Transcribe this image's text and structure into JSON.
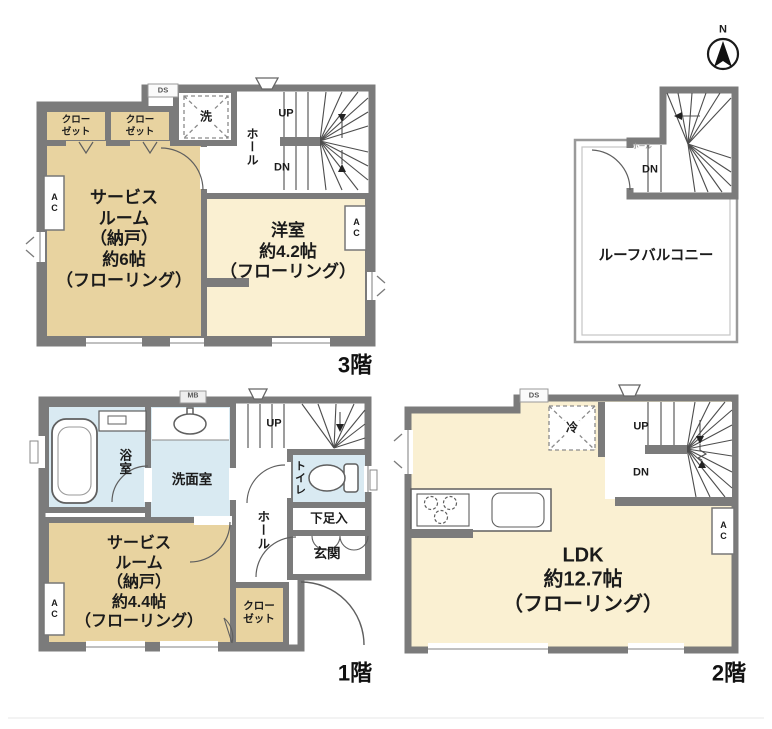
{
  "colors": {
    "wall": "#7b7b7b",
    "room_tan": "#e8d3a0",
    "room_cream": "#faf0d2",
    "room_blue": "#d9eaf2",
    "paper": "#ffffff"
  },
  "compass": {
    "north_label": "N"
  },
  "floor_3f": {
    "floor_label": "3階",
    "closet_left": [
      "クロー",
      "ゼット"
    ],
    "closet_right": [
      "クロー",
      "ゼット"
    ],
    "laundry_label": "洗",
    "hall_label": "ホール",
    "up_label": "UP",
    "down_label": "DN",
    "service_room": [
      "サービス",
      "ルーム",
      "（納戸）",
      "約6帖",
      "（フローリング）"
    ],
    "western_room": [
      "洋室",
      "約4.2帖",
      "（フローリング）"
    ],
    "ac_left": "AC",
    "ac_right": "AC",
    "duct_label": "DS"
  },
  "roof": {
    "balcony_label": "ルーフバルコニー",
    "hall_label": "ホール",
    "down_label": "DN"
  },
  "floor_1f": {
    "floor_label": "1階",
    "bath_label": "浴室",
    "washroom_label": "洗面室",
    "toilet_label": "トイレ",
    "hall_label": "ホール",
    "shoe_label": "下足入",
    "entrance_label": "玄関",
    "service_room": [
      "サービス",
      "ルーム",
      "（納戸）",
      "約4.4帖",
      "（フローリング）"
    ],
    "closet": [
      "クロー",
      "ゼット"
    ],
    "up_label": "UP",
    "ac_label": "AC",
    "meter_label": "MB"
  },
  "floor_2f": {
    "floor_label": "2階",
    "ldk": [
      "LDK",
      "約12.7帖",
      "（フローリング）"
    ],
    "fridge_label": "冷",
    "up_label": "UP",
    "down_label": "DN",
    "ac_label": "AC",
    "duct_label": "DS"
  }
}
